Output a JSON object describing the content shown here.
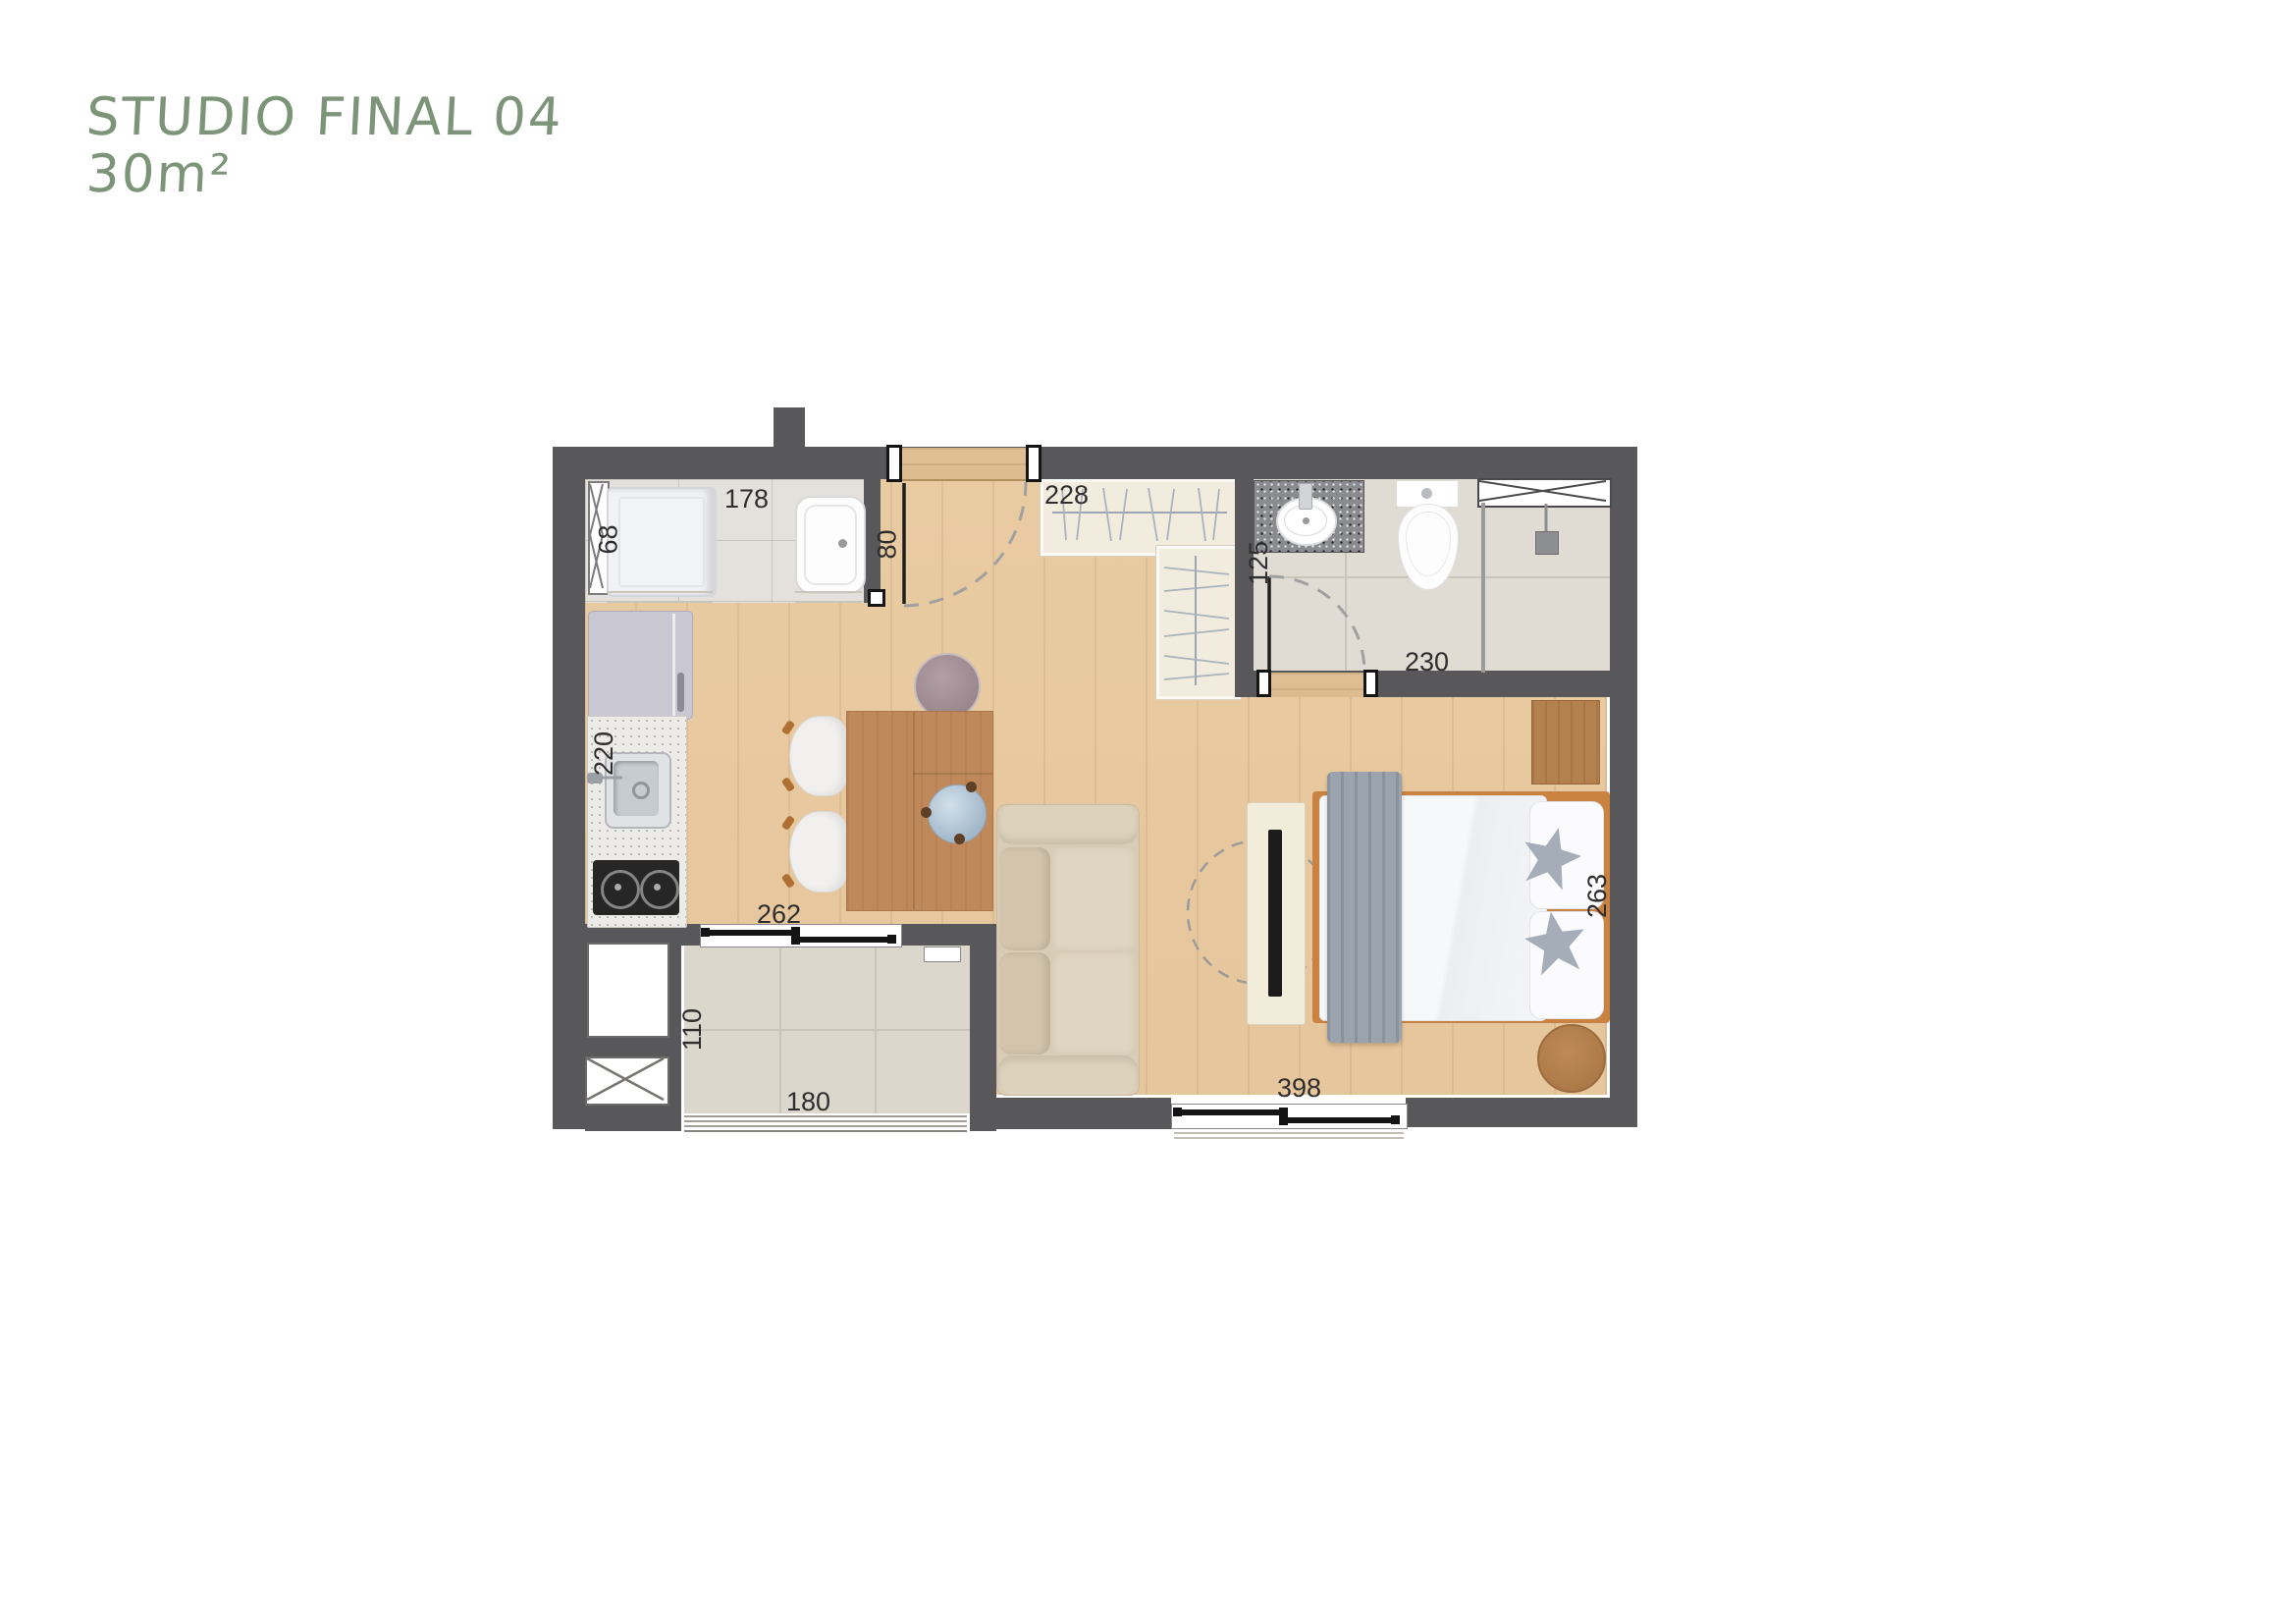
{
  "header": {
    "title": "STUDIO FINAL 04",
    "area": "30m²"
  },
  "colors": {
    "title_green": "#7c9477",
    "wall_gray": "#58575a",
    "wood_floor": "#e9cba2",
    "table_wood": "#c0895c",
    "bath_tile": "#e0dcd3"
  },
  "dimensions": {
    "laundry_width": "178",
    "washer_width": "68",
    "entry_clearance": "80",
    "closet_run": "228",
    "bathroom_depth": "125",
    "bathroom_width": "230",
    "kitchen_run": "220",
    "living_window": "262",
    "balcony_depth": "110",
    "balcony_width": "180",
    "bedroom_window": "398",
    "bedroom_depth": "263"
  }
}
